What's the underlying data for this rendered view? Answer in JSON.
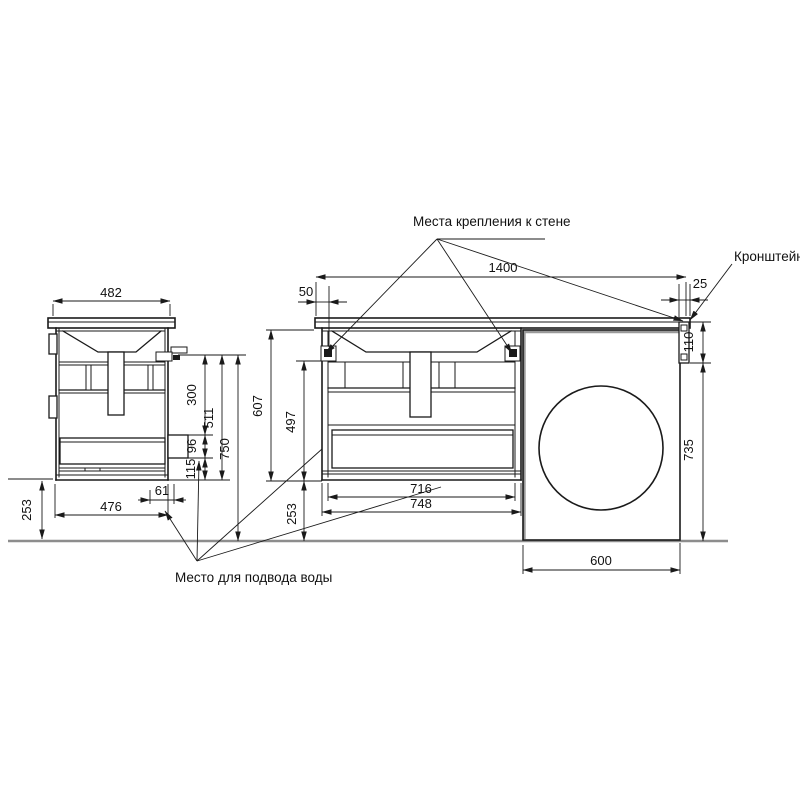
{
  "labels": {
    "wall_mount": "Места крепления к стене",
    "bracket": "Кронштейн",
    "water_supply": "Место для подвода воды"
  },
  "side": {
    "top_width": "482",
    "bottom_width": "476",
    "water_offset": "61",
    "floor_clearance": "253",
    "upper_section": "300",
    "mid_section": "511",
    "total_height": "750",
    "water_zone": "96",
    "water_lower": "115"
  },
  "front": {
    "total_width": "1400",
    "mount_offset": "50",
    "edge_offset": "25",
    "bracket_height": "110",
    "niche_height": "735",
    "cabinet_height": "607",
    "body_height": "497",
    "floor_clearance": "253",
    "inner_width": "716",
    "outer_width": "748",
    "machine_width": "600"
  }
}
